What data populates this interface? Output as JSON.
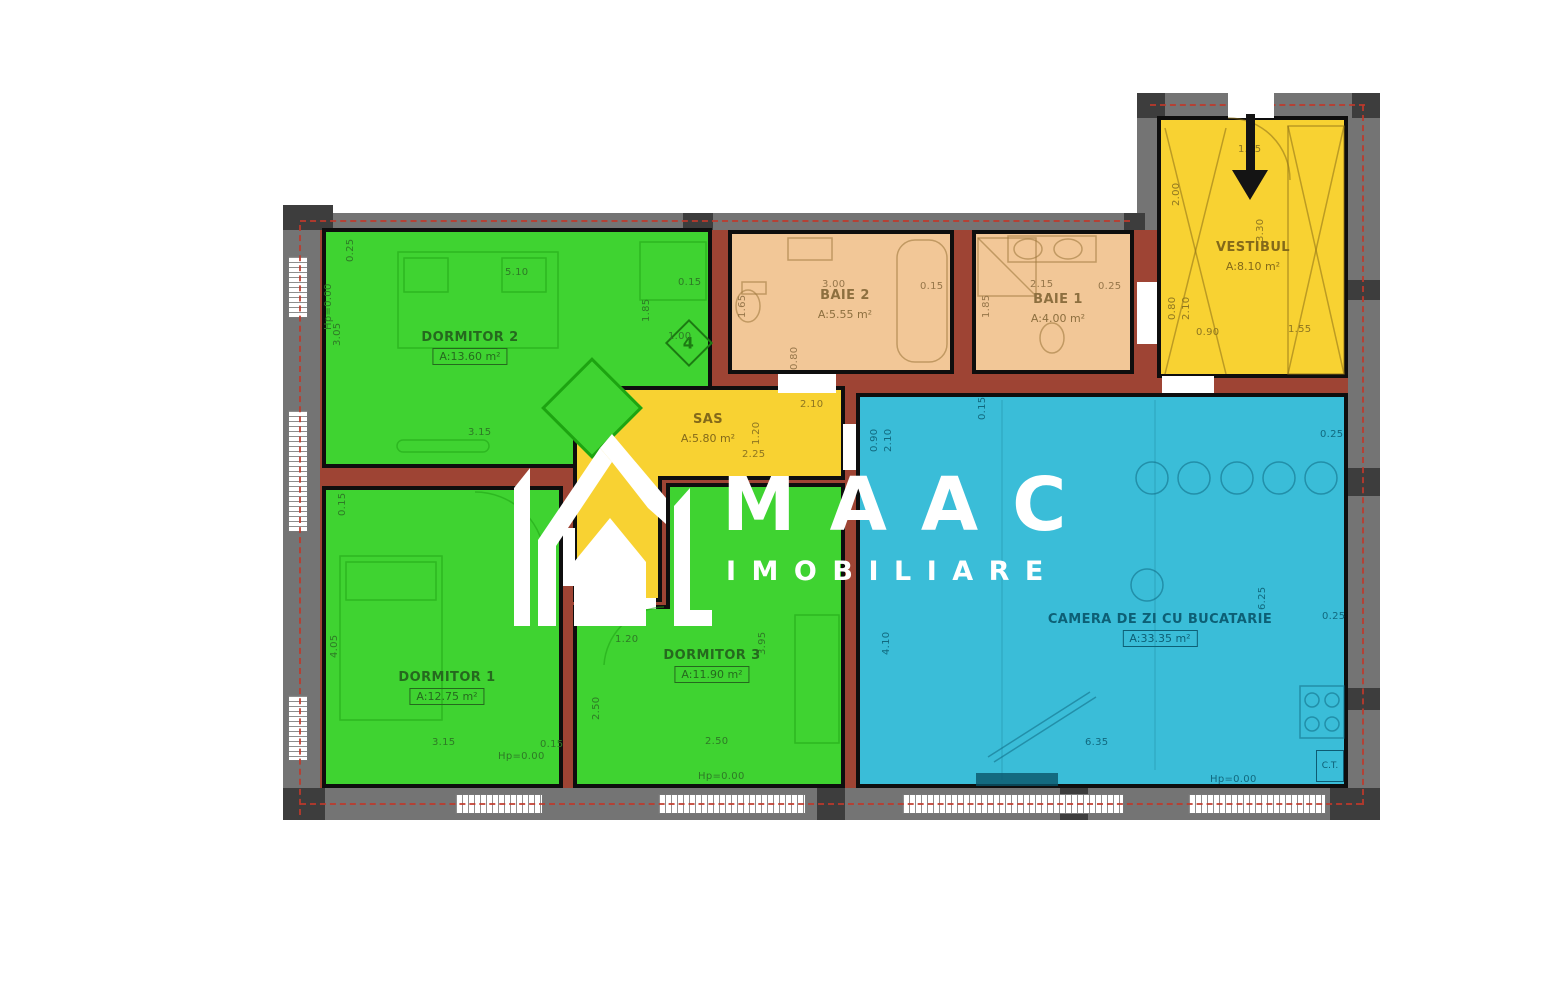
{
  "logo": {
    "name": "MAAC",
    "subtitle": "IMOBILIARE"
  },
  "rooms": [
    {
      "id": "dormitor2",
      "name": "DORMITOR 2",
      "area": "A:13.60 m²"
    },
    {
      "id": "baie2",
      "name": "BAIE 2",
      "area": "A:5.55 m²"
    },
    {
      "id": "baie1",
      "name": "BAIE 1",
      "area": "A:4.00 m²"
    },
    {
      "id": "vestibul",
      "name": "VESTIBUL",
      "area": "A:8.10 m²"
    },
    {
      "id": "sas",
      "name": "SAS",
      "area": "A:5.80 m²"
    },
    {
      "id": "dormitor1",
      "name": "DORMITOR 1",
      "area": "A:12.75 m²"
    },
    {
      "id": "dormitor3",
      "name": "DORMITOR 3",
      "area": "A:11.90 m²"
    },
    {
      "id": "camera",
      "name": "CAMERA DE ZI CU BUCATARIE",
      "area": "A:33.35 m²"
    }
  ],
  "annotations": {
    "room_tag": "4",
    "boiler": "C.T."
  },
  "colors": {
    "green": "#3fd331",
    "peach": "#f2c797",
    "yellow": "#f8d232",
    "blue": "#3abdd8",
    "brick": "#9e4434",
    "wall": "#747474",
    "dark": "#3d3d3d",
    "red": "#c0392b"
  },
  "dim_labels": [
    {
      "t": "0.25",
      "x": 346,
      "y": 262,
      "r": 1,
      "c": "dg"
    },
    {
      "t": "5.10",
      "x": 505,
      "y": 268,
      "r": 0,
      "c": "dg"
    },
    {
      "t": "0.15",
      "x": 678,
      "y": 278,
      "r": 0,
      "c": "dg"
    },
    {
      "t": "1.85",
      "x": 642,
      "y": 322,
      "r": 1,
      "c": "dg"
    },
    {
      "t": "1.00",
      "x": 668,
      "y": 332,
      "r": 0,
      "c": "dg"
    },
    {
      "t": "3.05",
      "x": 333,
      "y": 346,
      "r": 1,
      "c": "dg"
    },
    {
      "t": "3.15",
      "x": 468,
      "y": 428,
      "r": 0,
      "c": "dg"
    },
    {
      "t": "Hp=0.00",
      "x": 324,
      "y": 330,
      "r": 1,
      "c": "dg"
    },
    {
      "t": "0.15",
      "x": 338,
      "y": 516,
      "r": 1,
      "c": "dg"
    },
    {
      "t": "4.05",
      "x": 330,
      "y": 658,
      "r": 1,
      "c": "dg"
    },
    {
      "t": "3.15",
      "x": 432,
      "y": 738,
      "r": 0,
      "c": "dg"
    },
    {
      "t": "0.15",
      "x": 540,
      "y": 740,
      "r": 0,
      "c": "dg"
    },
    {
      "t": "Hp=0.00",
      "x": 498,
      "y": 752,
      "r": 0,
      "c": "dg"
    },
    {
      "t": "1.20",
      "x": 615,
      "y": 635,
      "r": 0,
      "c": "dg"
    },
    {
      "t": "2.50",
      "x": 592,
      "y": 720,
      "r": 1,
      "c": "dg"
    },
    {
      "t": "3.95",
      "x": 758,
      "y": 655,
      "r": 1,
      "c": "dg"
    },
    {
      "t": "2.50",
      "x": 705,
      "y": 737,
      "r": 0,
      "c": "dg"
    },
    {
      "t": "Hp=0.00",
      "x": 698,
      "y": 772,
      "r": 0,
      "c": "dg"
    },
    {
      "t": "3.00",
      "x": 822,
      "y": 280,
      "r": 0,
      "c": "do"
    },
    {
      "t": "0.15",
      "x": 920,
      "y": 282,
      "r": 0,
      "c": "do"
    },
    {
      "t": "1.65",
      "x": 738,
      "y": 318,
      "r": 1,
      "c": "do"
    },
    {
      "t": "0.80",
      "x": 790,
      "y": 370,
      "r": 1,
      "c": "do"
    },
    {
      "t": "2.15",
      "x": 1030,
      "y": 280,
      "r": 0,
      "c": "do"
    },
    {
      "t": "0.25",
      "x": 1098,
      "y": 282,
      "r": 0,
      "c": "do"
    },
    {
      "t": "1.85",
      "x": 982,
      "y": 318,
      "r": 1,
      "c": "do"
    },
    {
      "t": "2.00",
      "x": 1172,
      "y": 206,
      "r": 1,
      "c": "dy"
    },
    {
      "t": "1.45",
      "x": 1238,
      "y": 145,
      "r": 0,
      "c": "dy"
    },
    {
      "t": "3.30",
      "x": 1256,
      "y": 242,
      "r": 1,
      "c": "dy"
    },
    {
      "t": "0.80",
      "x": 1168,
      "y": 320,
      "r": 1,
      "c": "dy"
    },
    {
      "t": "2.10",
      "x": 1182,
      "y": 320,
      "r": 1,
      "c": "dy"
    },
    {
      "t": "0.90",
      "x": 1196,
      "y": 328,
      "r": 0,
      "c": "dy"
    },
    {
      "t": "1.55",
      "x": 1288,
      "y": 325,
      "r": 0,
      "c": "dy"
    },
    {
      "t": "2.10",
      "x": 800,
      "y": 400,
      "r": 0,
      "c": "dy"
    },
    {
      "t": "1.20",
      "x": 752,
      "y": 445,
      "r": 1,
      "c": "dy"
    },
    {
      "t": "2.25",
      "x": 742,
      "y": 450,
      "r": 0,
      "c": "dy"
    },
    {
      "t": "0.80",
      "x": 590,
      "y": 565,
      "r": 1,
      "c": "dy"
    },
    {
      "t": "0.90",
      "x": 870,
      "y": 452,
      "r": 1,
      "c": "db"
    },
    {
      "t": "2.10",
      "x": 884,
      "y": 452,
      "r": 1,
      "c": "db"
    },
    {
      "t": "0.15",
      "x": 978,
      "y": 420,
      "r": 1,
      "c": "db"
    },
    {
      "t": "0.25",
      "x": 1320,
      "y": 430,
      "r": 0,
      "c": "db"
    },
    {
      "t": "6.25",
      "x": 1258,
      "y": 610,
      "r": 1,
      "c": "db"
    },
    {
      "t": "0.25",
      "x": 1322,
      "y": 612,
      "r": 0,
      "c": "db"
    },
    {
      "t": "4.10",
      "x": 882,
      "y": 655,
      "r": 1,
      "c": "db"
    },
    {
      "t": "6.35",
      "x": 1085,
      "y": 738,
      "r": 0,
      "c": "db"
    },
    {
      "t": "Hp=0.00",
      "x": 1210,
      "y": 775,
      "r": 0,
      "c": "db"
    }
  ]
}
